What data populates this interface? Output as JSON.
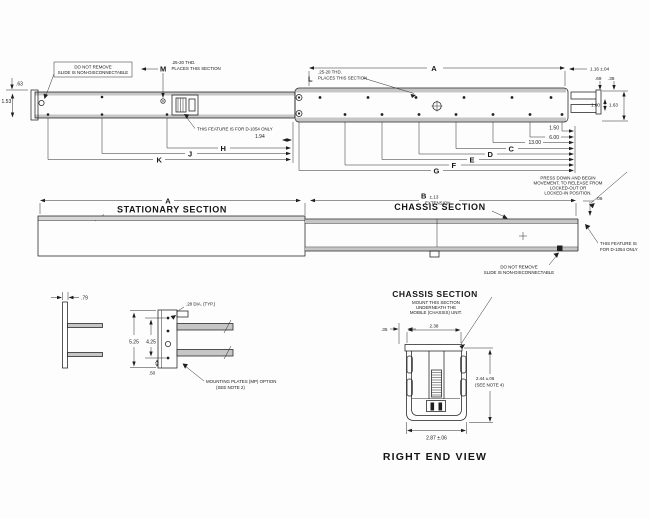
{
  "top_view": {
    "note_box": {
      "line1": "DO NOT REMOVE",
      "line2": "SLIDE IS NON-DISCONNECTABLE"
    },
    "callout_m": {
      "thread": ".25-20 THD.",
      "letter": "M",
      "places": "PLACES THIS SECTION"
    },
    "callout_l": {
      "thread": ".25-20 THD.",
      "letter": "L",
      "places": "PLACES THIS SECTION"
    },
    "dim_a": "A",
    "dim_63": ".63",
    "dim_153": "1.53",
    "feature_note": "THIS FEATURE IS FOR D-1054 ONLY",
    "dim_194": "1.94",
    "letter_h": "H",
    "letter_j": "J",
    "letter_k": "K",
    "dim_150": "1.50",
    "dim_600": "6.00",
    "dim_1300": "13.00",
    "letter_c": "C",
    "letter_d": "D",
    "letter_e": "E",
    "letter_f": "F",
    "letter_g": "G",
    "dim_116": "1.16 ±.04",
    "dim_69": ".69",
    "dim_38": ".38",
    "dim_100": "1.00",
    "dim_163": "1.63",
    "press_note": {
      "line1": "PRESS DOWN AND BEGIN",
      "line2": "MOVEMENT, TO RELEASE FROM",
      "line3": "LOCKED-OUT OR",
      "line4": "LOCKED-IN POSITION."
    }
  },
  "side_view": {
    "dim_a": "A",
    "stationary": "STATIONARY SECTION",
    "dim_b": "B",
    "dim_b_tol": "±.13",
    "extension": "EXTENSION",
    "chassis": "CHASSIS SECTION",
    "dim_06": ".06",
    "feature_note": {
      "line1": "THIS FEATURE IS",
      "line2": "FOR D-1054 ONLY"
    },
    "remove_note": {
      "line1": "DO NOT REMOVE",
      "line2": "SLIDE IS NON-DISCONNECTABLE"
    }
  },
  "bracket_view": {
    "dim_79": ".79",
    "dia_note": ".28 DIA. (TYP.)",
    "dim_525": "5.25",
    "dim_425": "4.25",
    "dim_50": ".50",
    "mount_note": {
      "line1": "MOUNTING PLATES (MP) OPTION",
      "line2": "(SEE NOTE 2)"
    }
  },
  "end_view": {
    "title": "CHASSIS SECTION",
    "subtitle": {
      "line1": "MOUNT THIS SECTION",
      "line2": "UNDERNEATH THE",
      "line3": "MOBILE (CHASSIS) UNIT."
    },
    "dim_35": ".35",
    "dim_238": "2.38",
    "dim_244": "2.44 ±.06",
    "dim_244_note": "(SEE NOTE 4)",
    "dim_287": "2.87 ±.06",
    "caption": "RIGHT END VIEW"
  }
}
